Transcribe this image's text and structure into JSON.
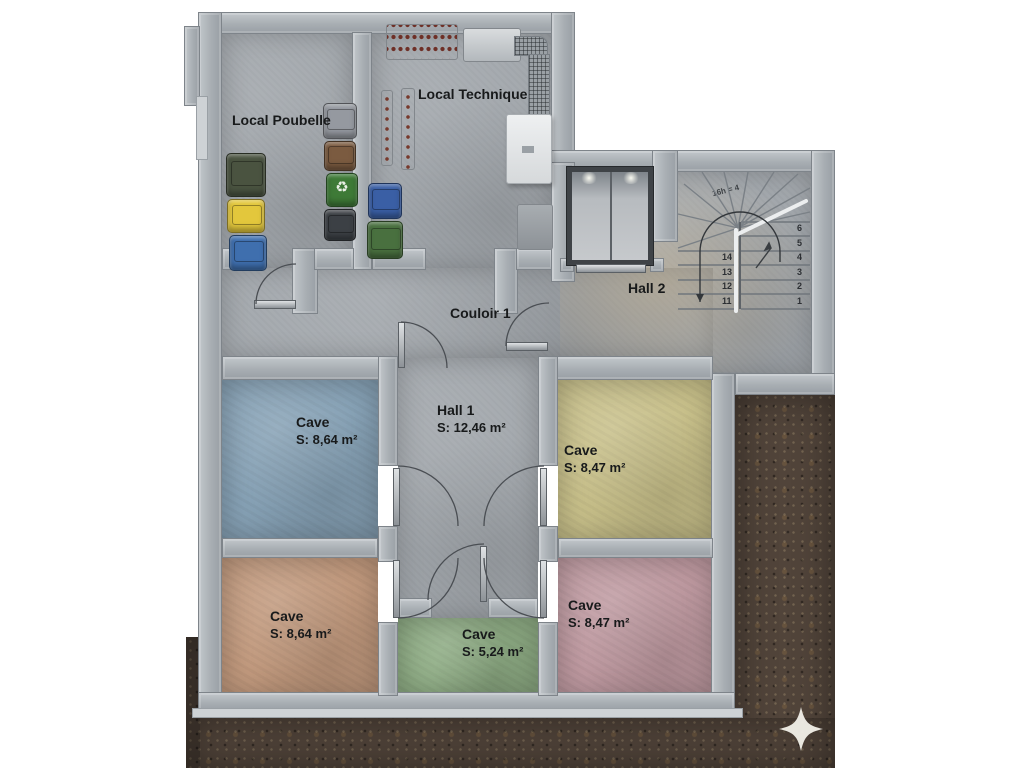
{
  "plan": {
    "type": "basement-floor-plan",
    "rooms": [
      {
        "id": "local-poubelle",
        "name": "Local Poubelle"
      },
      {
        "id": "local-technique",
        "name": "Local Technique"
      },
      {
        "id": "couloir-1",
        "name": "Couloir 1"
      },
      {
        "id": "hall-2",
        "name": "Hall 2"
      },
      {
        "id": "hall-1",
        "name": "Hall 1",
        "area": "S: 12,46 m²"
      },
      {
        "id": "cave-blue",
        "name": "Cave",
        "area": "S: 8,64 m²",
        "color": "#87a2b6"
      },
      {
        "id": "cave-yellow",
        "name": "Cave",
        "area": "S: 8,47 m²",
        "color": "#c8c08a"
      },
      {
        "id": "cave-orange",
        "name": "Cave",
        "area": "S: 8,64 m²",
        "color": "#c29a7e"
      },
      {
        "id": "cave-green",
        "name": "Cave",
        "area": "S: 5,24 m²",
        "color": "#8fad85"
      },
      {
        "id": "cave-pink",
        "name": "Cave",
        "area": "S: 8,47 m²",
        "color": "#bf9aa1"
      }
    ],
    "stairs": {
      "annotation": "16h = 4",
      "right_numbers": [
        "6",
        "5",
        "4",
        "3",
        "2",
        "1"
      ],
      "left_numbers": [
        "14",
        "13",
        "12",
        "11"
      ]
    },
    "colors": {
      "wall": "#a9aeb3",
      "floor": "#a2a7ac",
      "dirt": "#51443a",
      "cave_blue": "#87a2b6",
      "cave_yellow": "#c8c08a",
      "cave_orange": "#c29a7e",
      "cave_green": "#8fad85",
      "cave_pink": "#bf9aa1",
      "bin_yellow": "#e3c73c",
      "bin_blue": "#3f6fae",
      "bin_olive": "#4a5340",
      "bin_green": "#3e7a37",
      "bin_brown": "#7b5b40",
      "star": "#f2f0e9"
    },
    "icons": [
      "recycle-icon",
      "compass-star-icon",
      "elevator-light"
    ]
  }
}
